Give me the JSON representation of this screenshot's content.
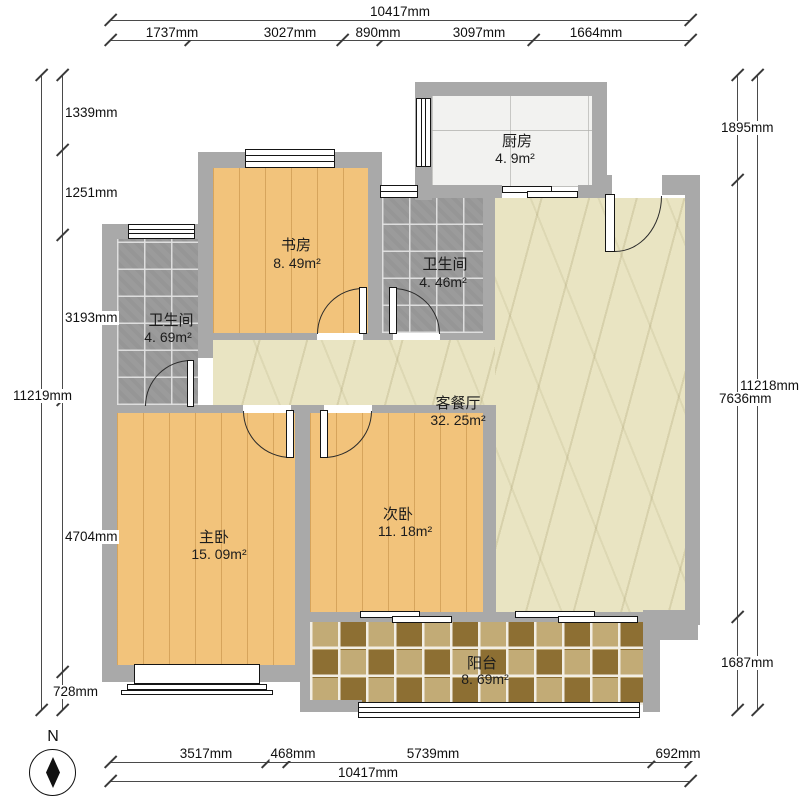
{
  "plan": {
    "rooms": [
      {
        "name": "厨房",
        "area": "4. 9m²"
      },
      {
        "name": "书房",
        "area": "8. 49m²"
      },
      {
        "name": "卫生间",
        "area": "4. 46m²"
      },
      {
        "name": "卫生间",
        "area": "4. 69m²"
      },
      {
        "name": "客餐厅",
        "area": "32. 25m²"
      },
      {
        "name": "主卧",
        "area": "15. 09m²"
      },
      {
        "name": "次卧",
        "area": "11. 18m²"
      },
      {
        "name": "阳台",
        "area": "8. 69m²"
      }
    ],
    "compass_label": "N"
  },
  "dimensions": {
    "top": {
      "total": "10417mm",
      "segments": [
        "1737mm",
        "3027mm",
        "890mm",
        "3097mm",
        "1664mm"
      ]
    },
    "bottom": {
      "total": "10417mm",
      "segments": [
        "3517mm",
        "468mm",
        "5739mm",
        "692mm"
      ]
    },
    "left": {
      "total": "11219mm",
      "segments": [
        "1339mm",
        "1251mm",
        "3193mm",
        "4704mm",
        "728mm"
      ]
    },
    "right": {
      "total": "11218mm",
      "segments": [
        "1895mm",
        "7636mm",
        "1687mm"
      ]
    }
  },
  "colors": {
    "wall": "#a9a9a9",
    "wood_floor": "#f2c37b",
    "living_floor": "#e9e4c2",
    "bath_tile": "#9b9b9b",
    "kitchen_tile": "#f2f2f0",
    "balcony_dark": "#8d6f33",
    "balcony_light": "#c2ab76"
  }
}
